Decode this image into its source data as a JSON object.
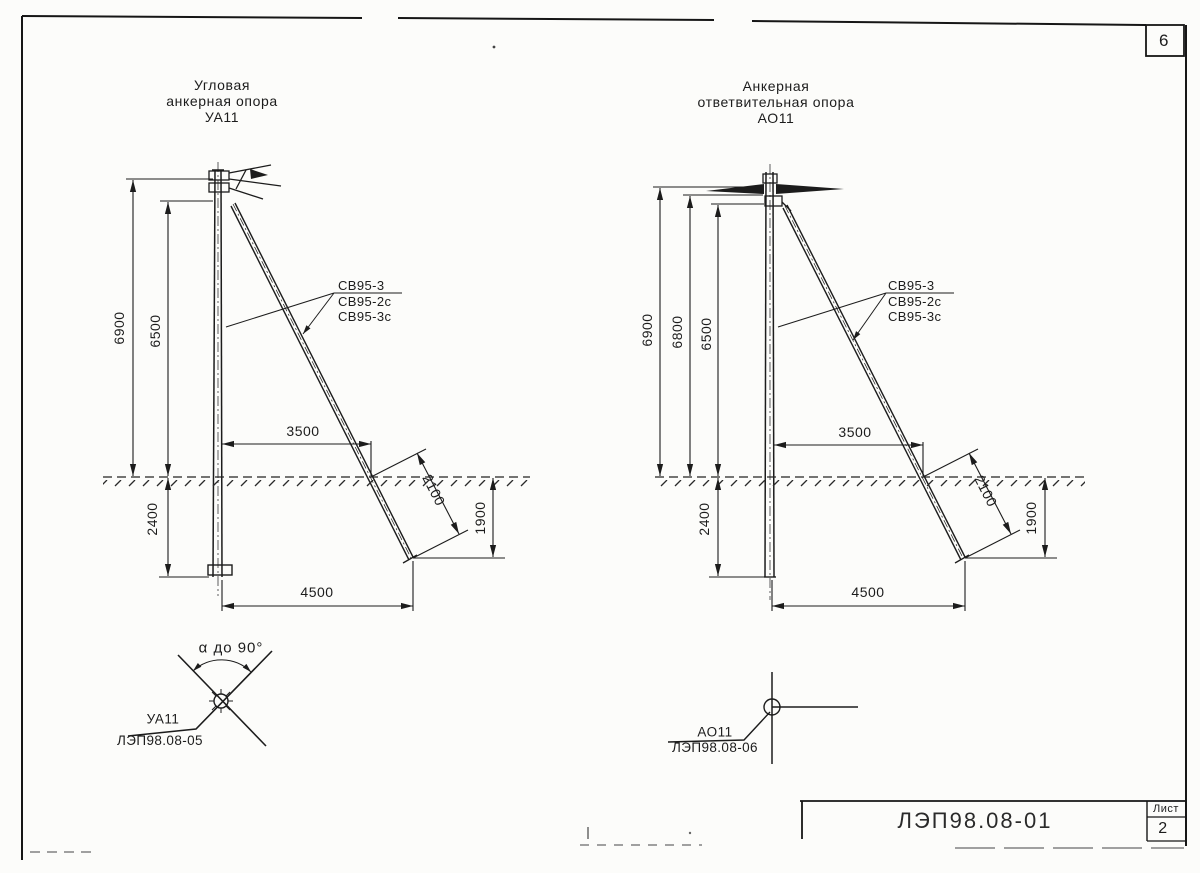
{
  "page": {
    "corner_number": "6",
    "title_block": {
      "document_number": "ЛЭП98.08-01",
      "sheet_label": "Лист",
      "sheet_number": "2"
    }
  },
  "ua11": {
    "title_line1": "Угловая",
    "title_line2": "анкерная опора",
    "title_line3": "УА11",
    "strut_label_1": "СВ95-3",
    "strut_label_2": "СВ95-2с",
    "strut_label_3": "СВ95-3с",
    "dim_total_height": "6900",
    "dim_hook_height": "6500",
    "dim_embed_depth": "2400",
    "dim_strut_offset": "3500",
    "dim_strut_below_len": "2100",
    "dim_strut_depth": "1900",
    "dim_base_span": "4500",
    "plan_angle_note": "α до 90°",
    "plan_name": "УА11",
    "plan_ref": "ЛЭП98.08-05"
  },
  "ao11": {
    "title_line1": "Анкерная",
    "title_line2": "ответвительная опора",
    "title_line3": "АО11",
    "strut_label_1": "СВ95-3",
    "strut_label_2": "СВ95-2с",
    "strut_label_3": "СВ95-3с",
    "dim_total_height": "6900",
    "dim_top_height": "6800",
    "dim_hook_height": "6500",
    "dim_embed_depth": "2400",
    "dim_strut_offset": "3500",
    "dim_strut_below_len": "2100",
    "dim_strut_depth": "1900",
    "dim_base_span": "4500",
    "plan_name": "АО11",
    "plan_ref": "ЛЭП98.08-06"
  }
}
